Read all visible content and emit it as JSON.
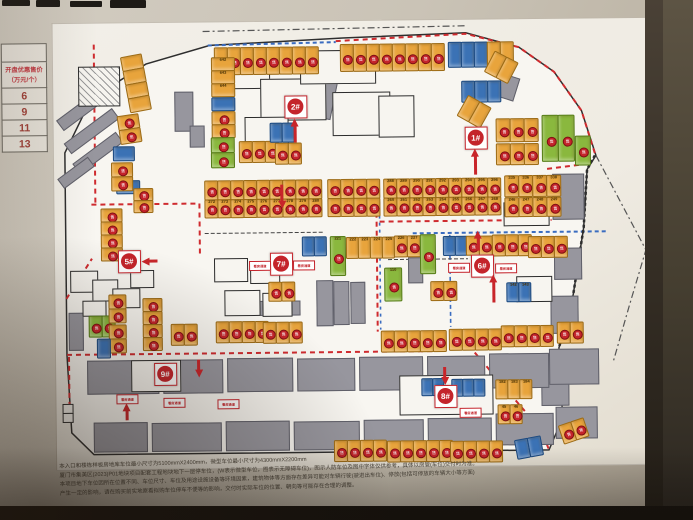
{
  "palette": {
    "wall": "#c7c0b3",
    "paper": "#f0ece3",
    "plot": "#f8f6f1",
    "orange": "#e8a43c",
    "orange_border": "#9c6b16",
    "blue": "#3b72b5",
    "blue_border": "#1d4a80",
    "green": "#8ab83e",
    "green_border": "#567d18",
    "gray_block": "#97969e",
    "red": "#c8252a",
    "dash_red": "#cf2b2f",
    "dash_blue": "#3a6cc0",
    "white_spot": "#f5f3ee"
  },
  "price_table": {
    "header1": "开盘优惠售价",
    "header2": "（万元/个）",
    "rows": [
      "6",
      "9",
      "11",
      "13"
    ]
  },
  "badge_glyph": "售",
  "sign_text": "看房通道",
  "markers": [
    [
      "1#",
      476,
      138
    ],
    [
      "2#",
      296,
      105
    ],
    [
      "5#",
      128,
      258
    ],
    [
      "6#",
      481,
      266
    ],
    [
      "7#",
      280,
      262
    ],
    [
      "8#",
      443,
      396
    ],
    [
      "9#",
      163,
      371
    ]
  ],
  "signs": [
    [
      259,
      264
    ],
    [
      303,
      264
    ],
    [
      458,
      268
    ],
    [
      505,
      269
    ],
    [
      125,
      396
    ],
    [
      172,
      400
    ],
    [
      226,
      402
    ],
    [
      468,
      413
    ]
  ],
  "arrows": [
    [
      296,
      118,
      24,
      0
    ],
    [
      476,
      150,
      26,
      0
    ],
    [
      141,
      259,
      16,
      -90
    ],
    [
      282,
      208,
      24,
      180
    ],
    [
      478,
      232,
      20,
      0
    ],
    [
      493,
      276,
      28,
      0
    ],
    [
      197,
      376,
      18,
      180
    ],
    [
      125,
      401,
      17,
      0
    ],
    [
      443,
      386,
      18,
      180
    ]
  ],
  "map": {
    "plot_outline": "93,96 148,62 212,44 345,38 468,34 521,49 556,74 583,113 597,158 588,172 584,230 572,302 558,350 561,420 547,452 92,452 70,430 66,352 66,150",
    "lines": [
      {
        "p": "205,30 470,27",
        "c": "#555555",
        "w": 1.2,
        "d": "7,3,2,3"
      },
      {
        "p": "597,158 646,253 629,308 612,365",
        "c": "#555555",
        "w": 1.2,
        "d": "7,3,2,3"
      },
      {
        "p": "338,41 468,35 521,49 556,74 583,113 596,156",
        "c": "#cf2b2f",
        "w": 2,
        "d": "5,4"
      },
      {
        "p": "210,44 338,42",
        "c": "#3a6cc0",
        "w": 2,
        "d": "4,3"
      },
      {
        "p": "96,42 96,200",
        "c": "#cf2b2f",
        "w": 2,
        "d": "5,4"
      },
      {
        "p": "92,202 200,202 200,253",
        "c": "#cf2b2f",
        "w": 2,
        "d": "5,4"
      },
      {
        "p": "66,296 92,256",
        "c": "#cf2b2f",
        "w": 2,
        "d": "5,4"
      },
      {
        "p": "66,352 432,352",
        "c": "#cf2b2f",
        "w": 2,
        "d": "5,4"
      },
      {
        "p": "68,354 68,418",
        "c": "#cf2b2f",
        "w": 2,
        "d": "5,4"
      },
      {
        "p": "377,186 377,332",
        "c": "#cf2b2f",
        "w": 2,
        "d": "5,4"
      },
      {
        "p": "380,188 380,330",
        "c": "#3a6cc0",
        "w": 1.6,
        "d": "3,4"
      },
      {
        "p": "380,222 552,222",
        "c": "#cf2b2f",
        "w": 2,
        "d": "5,4"
      },
      {
        "p": "548,171 591,166",
        "c": "#cf2b2f",
        "w": 2,
        "d": "5,4"
      },
      {
        "p": "413,234 608,234",
        "c": "#3a6cc0",
        "w": 2,
        "d": "4,3"
      },
      {
        "p": "450,236 450,328",
        "c": "#3a6cc0",
        "w": 1.6,
        "d": "4,3"
      },
      {
        "p": "468,347 540,433 547,452",
        "c": "#cf2b2f",
        "w": 2,
        "d": "5,4"
      },
      {
        "p": "596,158 588,172 584,230 572,302 558,350",
        "c": "#2e2e2e",
        "w": 2.5,
        "d": "3,2.5"
      },
      {
        "p": "205,232 325,232",
        "c": "#444444",
        "w": 1,
        "d": "4,2"
      },
      {
        "p": "388,260 468,260",
        "c": "#444444",
        "w": 1,
        "d": "4,2"
      }
    ],
    "gray_blocks": [
      [
        56,
        100,
        54,
        11,
        -36
      ],
      [
        63,
        122,
        58,
        11,
        -36
      ],
      [
        72,
        144,
        52,
        11,
        -36
      ],
      [
        58,
        164,
        36,
        10,
        -36
      ],
      [
        313,
        80,
        21,
        36,
        12
      ],
      [
        500,
        77,
        17,
        22,
        18
      ],
      [
        176,
        90,
        17,
        38,
        0
      ],
      [
        191,
        124,
        13,
        20,
        0
      ],
      [
        553,
        176,
        30,
        44,
        0
      ],
      [
        554,
        250,
        26,
        30,
        0
      ],
      [
        550,
        298,
        26,
        36,
        0
      ],
      [
        316,
        280,
        15,
        44,
        0
      ],
      [
        333,
        281,
        14,
        42,
        0
      ],
      [
        350,
        282,
        13,
        40,
        0
      ],
      [
        408,
        258,
        13,
        24,
        0
      ],
      [
        254,
        300,
        44,
        13,
        0
      ],
      [
        68,
        310,
        13,
        36,
        0
      ],
      [
        540,
        384,
        26,
        22,
        0
      ],
      [
        86,
        358,
        70,
        32,
        0
      ],
      [
        162,
        358,
        58,
        32,
        0
      ],
      [
        226,
        357,
        64,
        32,
        0
      ],
      [
        296,
        358,
        56,
        31,
        0
      ],
      [
        358,
        357,
        62,
        32,
        0
      ],
      [
        426,
        357,
        56,
        32,
        0
      ],
      [
        488,
        355,
        58,
        33,
        0
      ],
      [
        548,
        351,
        48,
        34,
        0
      ],
      [
        92,
        420,
        52,
        28,
        0
      ],
      [
        150,
        421,
        68,
        27,
        0
      ],
      [
        224,
        420,
        62,
        28,
        0
      ],
      [
        292,
        421,
        64,
        27,
        0
      ],
      [
        362,
        420,
        58,
        28,
        0
      ],
      [
        426,
        419,
        62,
        28,
        0
      ],
      [
        494,
        415,
        56,
        30,
        0
      ],
      [
        554,
        409,
        40,
        30,
        0
      ]
    ],
    "buildings": [
      [
        214,
        56,
        56,
        30
      ],
      [
        262,
        78,
        64,
        40
      ],
      [
        302,
        50,
        74,
        32
      ],
      [
        334,
        92,
        56,
        42
      ],
      [
        246,
        116,
        42,
        26
      ],
      [
        380,
        96,
        34,
        40
      ],
      [
        70,
        268,
        26,
        20
      ],
      [
        92,
        277,
        24,
        20
      ],
      [
        112,
        286,
        26,
        18
      ],
      [
        130,
        268,
        22,
        16
      ],
      [
        82,
        298,
        22,
        14
      ],
      [
        214,
        257,
        32,
        22
      ],
      [
        250,
        261,
        28,
        20
      ],
      [
        224,
        289,
        34,
        24
      ],
      [
        262,
        292,
        28,
        22
      ],
      [
        398,
        376,
        92,
        38
      ],
      [
        130,
        358,
        48,
        30
      ],
      [
        504,
        204,
        44,
        22
      ],
      [
        516,
        278,
        34,
        24
      ]
    ],
    "hatch_building": [
      80,
      64,
      40,
      38
    ],
    "clusters": [
      [
        216,
        46,
        8,
        12,
        26,
        "o",
        1,
        0,
        0,
        null
      ],
      [
        342,
        44,
        8,
        12,
        26,
        "o",
        1,
        0,
        0,
        null
      ],
      [
        450,
        43,
        5,
        12,
        24,
        "bbboo",
        0,
        0,
        0,
        null
      ],
      [
        497,
        52,
        2,
        12,
        22,
        "o",
        0,
        0,
        28,
        null
      ],
      [
        463,
        82,
        3,
        12,
        20,
        "b",
        0,
        0,
        0,
        null
      ],
      [
        213,
        56,
        3,
        22,
        12,
        "o",
        0,
        1,
        0,
        642
      ],
      [
        213,
        96,
        1,
        22,
        12,
        "b",
        0,
        1,
        0,
        null
      ],
      [
        213,
        110,
        2,
        22,
        12,
        "o",
        1,
        1,
        0,
        null
      ],
      [
        212,
        136,
        2,
        22,
        14,
        "g",
        1,
        1,
        0,
        null
      ],
      [
        240,
        140,
        3,
        12,
        20,
        "o",
        1,
        0,
        0,
        null
      ],
      [
        276,
        142,
        2,
        12,
        20,
        "o",
        1,
        0,
        0,
        null
      ],
      [
        271,
        122,
        2,
        11,
        18,
        "b",
        0,
        0,
        0,
        null
      ],
      [
        497,
        120,
        3,
        13,
        22,
        "o",
        1,
        0,
        0,
        null
      ],
      [
        497,
        145,
        3,
        13,
        20,
        "o",
        1,
        0,
        0,
        null
      ],
      [
        543,
        117,
        2,
        15,
        45,
        "g",
        1,
        0,
        0,
        null
      ],
      [
        576,
        138,
        1,
        14,
        28,
        "g",
        1,
        0,
        0,
        null
      ],
      [
        470,
        96,
        2,
        12,
        22,
        "o",
        0,
        0,
        30,
        null
      ],
      [
        205,
        179,
        9,
        12,
        18,
        "o",
        1,
        0,
        0,
        null
      ],
      [
        328,
        179,
        4,
        12,
        18,
        "o",
        1,
        0,
        0,
        null
      ],
      [
        384,
        179,
        9,
        12,
        18,
        "o",
        1,
        0,
        0,
        288
      ],
      [
        505,
        177,
        4,
        13,
        20,
        "o",
        1,
        0,
        0,
        335
      ],
      [
        205,
        198,
        9,
        12,
        17,
        "o",
        1,
        0,
        0,
        272
      ],
      [
        328,
        198,
        4,
        12,
        17,
        "o",
        1,
        0,
        0,
        null
      ],
      [
        384,
        198,
        9,
        12,
        17,
        "o",
        1,
        0,
        0,
        260
      ],
      [
        505,
        199,
        4,
        13,
        18,
        "o",
        1,
        0,
        0,
        246
      ],
      [
        330,
        236,
        1,
        14,
        38,
        "g",
        1,
        0,
        0,
        221
      ],
      [
        346,
        237,
        4,
        11,
        20,
        "o",
        0,
        0,
        0,
        222
      ],
      [
        394,
        236,
        3,
        12,
        20,
        "o",
        1,
        0,
        0,
        226
      ],
      [
        302,
        236,
        2,
        11,
        18,
        "b",
        0,
        0,
        0,
        null
      ],
      [
        420,
        235,
        1,
        14,
        38,
        "g",
        1,
        0,
        0,
        null
      ],
      [
        443,
        237,
        2,
        11,
        18,
        "b",
        0,
        0,
        0,
        null
      ],
      [
        466,
        237,
        2,
        12,
        18,
        "o",
        1,
        0,
        0,
        null
      ],
      [
        492,
        236,
        3,
        12,
        20,
        "o",
        1,
        0,
        0,
        null
      ],
      [
        528,
        238,
        3,
        12,
        20,
        "o",
        1,
        0,
        0,
        null
      ],
      [
        268,
        281,
        2,
        12,
        18,
        "o",
        1,
        0,
        0,
        null
      ],
      [
        384,
        268,
        1,
        16,
        32,
        "g",
        1,
        0,
        0,
        110
      ],
      [
        430,
        282,
        2,
        12,
        18,
        "o",
        1,
        0,
        0,
        null
      ],
      [
        506,
        284,
        2,
        11,
        18,
        "b",
        0,
        0,
        0,
        142
      ],
      [
        117,
        178,
        1,
        22,
        12,
        "b",
        0,
        1,
        0,
        null
      ],
      [
        101,
        206,
        4,
        20,
        12,
        "o",
        1,
        1,
        0,
        null
      ],
      [
        134,
        186,
        2,
        18,
        11,
        "o",
        1,
        1,
        0,
        null
      ],
      [
        88,
        313,
        2,
        12,
        20,
        "g",
        1,
        0,
        0,
        null
      ],
      [
        108,
        292,
        2,
        16,
        13,
        "o",
        1,
        1,
        0,
        null
      ],
      [
        108,
        322,
        2,
        16,
        13,
        "o",
        1,
        1,
        0,
        null
      ],
      [
        96,
        336,
        1,
        12,
        18,
        "b",
        0,
        0,
        0,
        null
      ],
      [
        142,
        296,
        4,
        18,
        12,
        "o",
        1,
        1,
        0,
        null
      ],
      [
        170,
        322,
        2,
        12,
        20,
        "o",
        1,
        0,
        0,
        null
      ],
      [
        215,
        320,
        4,
        12,
        20,
        "o",
        1,
        0,
        0,
        null
      ],
      [
        262,
        321,
        3,
        12,
        20,
        "o",
        1,
        0,
        0,
        null
      ],
      [
        380,
        331,
        5,
        12,
        20,
        "o",
        1,
        0,
        0,
        null
      ],
      [
        448,
        330,
        4,
        12,
        20,
        "o",
        1,
        0,
        0,
        null
      ],
      [
        500,
        327,
        4,
        12,
        20,
        "o",
        1,
        0,
        0,
        null
      ],
      [
        556,
        324,
        2,
        12,
        20,
        "o",
        1,
        0,
        0,
        null
      ],
      [
        332,
        440,
        4,
        12,
        20,
        "o",
        1,
        0,
        0,
        null
      ],
      [
        385,
        441,
        5,
        12,
        20,
        "o",
        1,
        0,
        0,
        null
      ],
      [
        448,
        442,
        4,
        12,
        20,
        "o",
        1,
        0,
        0,
        null
      ],
      [
        512,
        442,
        2,
        12,
        18,
        "b",
        0,
        0,
        -10,
        null
      ],
      [
        556,
        428,
        2,
        12,
        18,
        "o",
        1,
        0,
        -18,
        null
      ],
      [
        494,
        381,
        3,
        11,
        18,
        "o",
        0,
        0,
        0,
        182
      ],
      [
        496,
        406,
        2,
        11,
        18,
        "o",
        1,
        0,
        0,
        45
      ],
      [
        420,
        379,
        2,
        10,
        16,
        "b",
        0,
        0,
        0,
        null
      ],
      [
        450,
        380,
        3,
        10,
        16,
        "b",
        0,
        0,
        0,
        null
      ],
      [
        122,
        55,
        4,
        20,
        13,
        "o",
        0,
        1,
        -10,
        null
      ],
      [
        118,
        114,
        2,
        20,
        13,
        "o",
        1,
        1,
        -8,
        null
      ],
      [
        114,
        144,
        1,
        20,
        13,
        "b",
        0,
        1,
        0,
        null
      ],
      [
        112,
        160,
        2,
        20,
        13,
        "o",
        1,
        1,
        0,
        null
      ]
    ]
  },
  "footnotes": [
    "本入口和楼栋样板房地库车位最小尺寸为5100mmX2400mm，微型车位最小尺寸为4300mmX2200mm",
    "厦门市集美区(2023)P01地块项目配套工程地块地下一层停车位，(W表示微型车位，图表示无障碍车位)，图示人防车位及图中字体仅供参考，具体以房管(车位)交付时为准。",
    "本项目地下车位因所在位置不同、车位尺寸、车位及用途设施设备等环境因素，建筑物体等方面存在差异可能对车辆行驶(驶进出车位)、停放(包括可停放的车辆大小等方面)",
    "产生一定的影响，请在购买前实地察看拟购车位停车不便等的影响，交付时实际车位的位置、朝向等可能存在合理的调整。"
  ]
}
